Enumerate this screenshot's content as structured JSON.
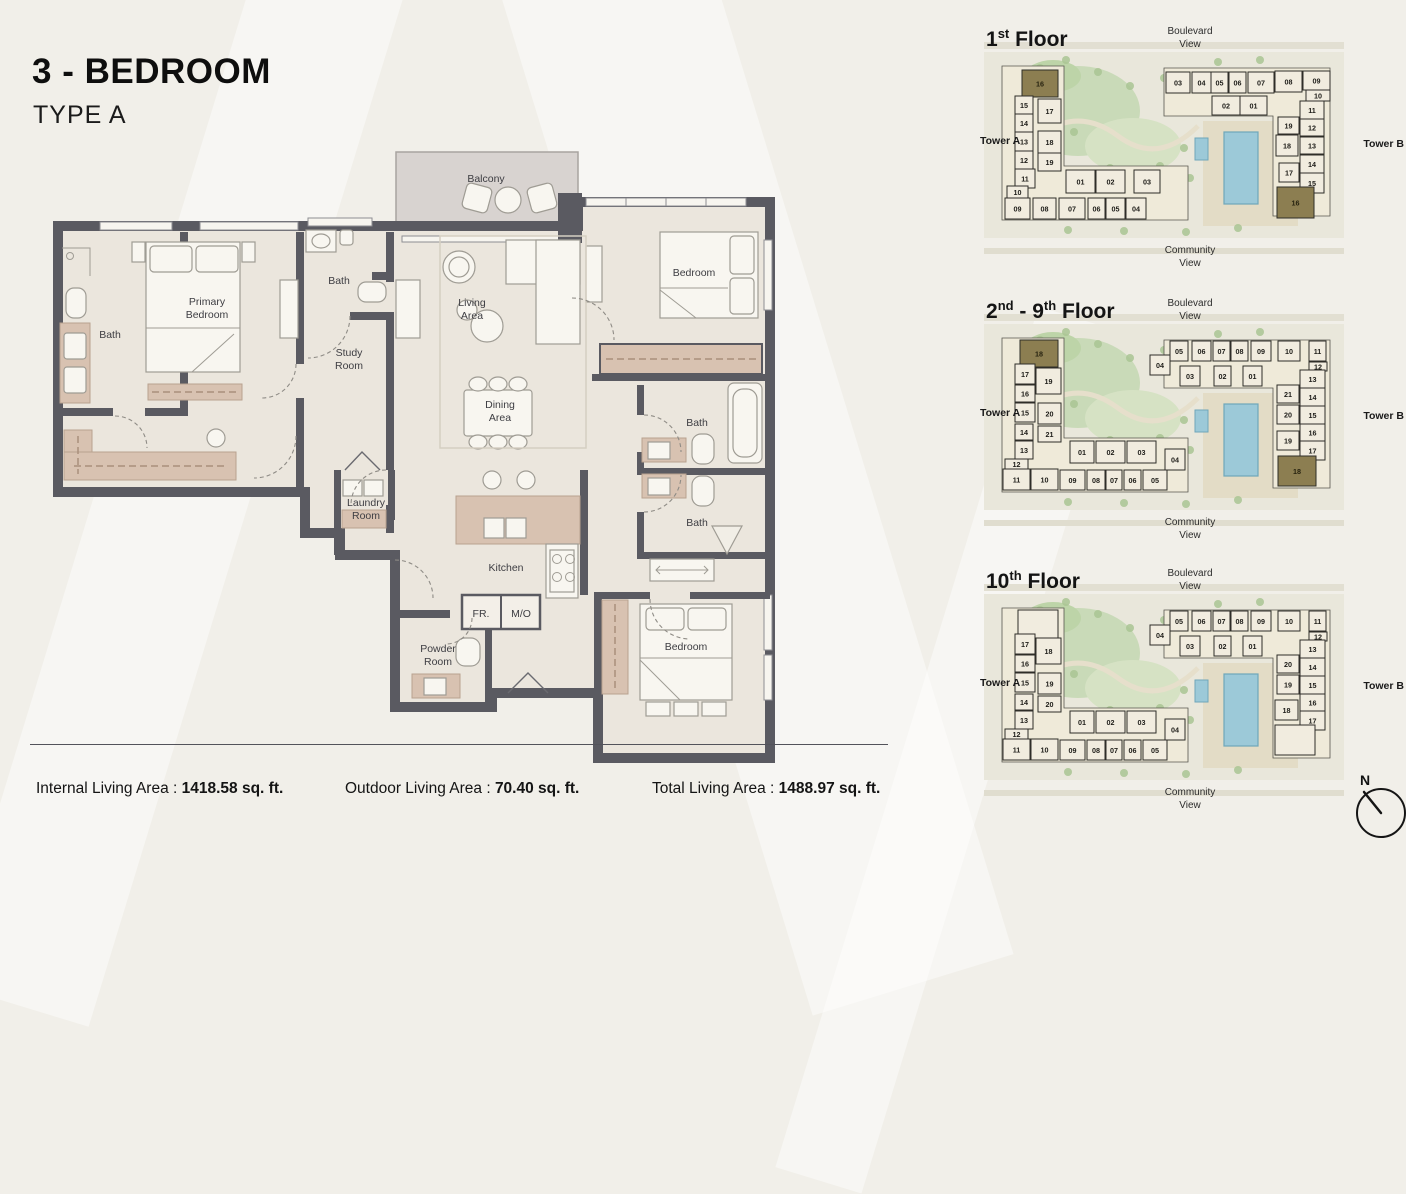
{
  "header": {
    "title": "3 - BEDROOM",
    "subtitle": "TYPE A"
  },
  "stats": [
    {
      "label": "Internal Living Area",
      "sep": " : ",
      "value": "1418.58 sq. ft."
    },
    {
      "label": "Outdoor Living Area",
      "sep": " : ",
      "value": "70.40 sq. ft."
    },
    {
      "label": "Total Living Area",
      "sep": " : ",
      "value": "1488.97 sq. ft."
    }
  ],
  "floor_plan": {
    "rooms": [
      {
        "id": "bath-left",
        "lines": [
          "Bath"
        ],
        "x": 70,
        "y": 198
      },
      {
        "id": "primary-bedroom",
        "lines": [
          "Primary",
          "Bedroom"
        ],
        "x": 167,
        "y": 165
      },
      {
        "id": "bath-middle",
        "lines": [
          "Bath"
        ],
        "x": 299,
        "y": 144
      },
      {
        "id": "study-room",
        "lines": [
          "Study",
          "Room"
        ],
        "x": 309,
        "y": 216
      },
      {
        "id": "balcony",
        "lines": [
          "Balcony"
        ],
        "x": 446,
        "y": 42
      },
      {
        "id": "living-area",
        "lines": [
          "Living",
          "Area"
        ],
        "x": 432,
        "y": 166
      },
      {
        "id": "bedroom-top",
        "lines": [
          "Bedroom"
        ],
        "x": 654,
        "y": 136
      },
      {
        "id": "dining-area",
        "lines": [
          "Dining",
          "Area"
        ],
        "x": 460,
        "y": 268
      },
      {
        "id": "bath-upper",
        "lines": [
          "Bath"
        ],
        "x": 657,
        "y": 286
      },
      {
        "id": "bath-lower",
        "lines": [
          "Bath"
        ],
        "x": 657,
        "y": 386
      },
      {
        "id": "laundry-room",
        "lines": [
          "Laundry",
          "Room"
        ],
        "x": 326,
        "y": 366
      },
      {
        "id": "kitchen",
        "lines": [
          "Kitchen"
        ],
        "x": 466,
        "y": 431
      },
      {
        "id": "fr",
        "lines": [
          "FR."
        ],
        "x": 441,
        "y": 477
      },
      {
        "id": "mo",
        "lines": [
          "M/O"
        ],
        "x": 481,
        "y": 477
      },
      {
        "id": "powder-room",
        "lines": [
          "Powder",
          "Room"
        ],
        "x": 398,
        "y": 512
      },
      {
        "id": "bedroom-bottom",
        "lines": [
          "Bedroom"
        ],
        "x": 646,
        "y": 510
      }
    ]
  },
  "key_plans": [
    {
      "id": "1st-floor",
      "title": [
        [
          "1",
          false
        ],
        [
          "st",
          true
        ],
        [
          " Floor",
          false
        ]
      ],
      "boulevard": [
        "Boulevard",
        "View"
      ],
      "community": [
        "Community",
        "View"
      ],
      "tower_a": "Tower A",
      "tower_b": "Tower B",
      "units_a": [
        [
          "16",
          44,
          54,
          36,
          27,
          1
        ],
        [
          "15",
          37,
          80,
          18,
          18
        ],
        [
          "14",
          37,
          98,
          18,
          18
        ],
        [
          "13",
          37,
          116,
          18,
          19
        ],
        [
          "12",
          37,
          135,
          18,
          18
        ],
        [
          "11",
          37,
          153,
          20,
          19
        ],
        [
          "17",
          60,
          83,
          23,
          24
        ],
        [
          "18",
          60,
          115,
          23,
          22
        ],
        [
          "19",
          60,
          137,
          23,
          18
        ],
        [
          "10",
          29,
          170,
          21,
          12
        ],
        [
          "09",
          27,
          182,
          25,
          21
        ],
        [
          "08",
          55,
          182,
          23,
          21
        ],
        [
          "07",
          81,
          182,
          26,
          21
        ],
        [
          "06",
          110,
          182,
          17,
          21
        ],
        [
          "05",
          128,
          182,
          19,
          21
        ],
        [
          "04",
          148,
          182,
          20,
          21
        ],
        [
          "01",
          88,
          154,
          29,
          23
        ],
        [
          "02",
          118,
          154,
          29,
          23
        ],
        [
          "03",
          156,
          154,
          26,
          23
        ]
      ],
      "units_b": [
        [
          "03",
          188,
          56,
          24,
          21
        ],
        [
          "04",
          214,
          56,
          19,
          21
        ],
        [
          "05",
          233,
          56,
          17,
          21
        ],
        [
          "06",
          251,
          56,
          17,
          21
        ],
        [
          "07",
          270,
          56,
          26,
          21
        ],
        [
          "08",
          297,
          55,
          27,
          21
        ],
        [
          "09",
          325,
          55,
          27,
          19
        ],
        [
          "10",
          328,
          74,
          24,
          11
        ],
        [
          "02",
          234,
          80,
          28,
          19
        ],
        [
          "01",
          262,
          80,
          27,
          19
        ],
        [
          "11",
          322,
          85,
          24,
          18
        ],
        [
          "12",
          322,
          103,
          24,
          17
        ],
        [
          "13",
          322,
          121,
          24,
          17
        ],
        [
          "14",
          322,
          139,
          24,
          18
        ],
        [
          "15",
          322,
          157,
          24,
          20
        ],
        [
          "19",
          300,
          101,
          21,
          17
        ],
        [
          "18",
          298,
          119,
          22,
          21
        ],
        [
          "17",
          301,
          147,
          20,
          19
        ],
        [
          "16",
          299,
          171,
          37,
          31,
          1
        ]
      ]
    },
    {
      "id": "2nd-9th-floor",
      "title": [
        [
          "2",
          false
        ],
        [
          "nd",
          true
        ],
        [
          " - 9",
          false
        ],
        [
          "th",
          true
        ],
        [
          " Floor",
          false
        ]
      ],
      "boulevard": [
        "Boulevard",
        "View"
      ],
      "community": [
        "Community",
        "View"
      ],
      "tower_a": "Tower A",
      "tower_b": "Tower B",
      "units_a": [
        [
          "18",
          42,
          52,
          38,
          27,
          1
        ],
        [
          "17",
          37,
          76,
          20,
          20
        ],
        [
          "16",
          37,
          97,
          20,
          17
        ],
        [
          "15",
          37,
          115,
          20,
          19
        ],
        [
          "14",
          37,
          136,
          18,
          16
        ],
        [
          "13",
          37,
          153,
          18,
          18
        ],
        [
          "19",
          58,
          80,
          25,
          26
        ],
        [
          "20",
          60,
          115,
          23,
          21
        ],
        [
          "21",
          60,
          138,
          23,
          16
        ],
        [
          "12",
          27,
          171,
          23,
          10
        ],
        [
          "11",
          25,
          181,
          27,
          21
        ],
        [
          "10",
          53,
          181,
          27,
          21
        ],
        [
          "09",
          82,
          182,
          25,
          20
        ],
        [
          "08",
          109,
          182,
          18,
          20
        ],
        [
          "07",
          128,
          182,
          16,
          20
        ],
        [
          "06",
          146,
          182,
          17,
          20
        ],
        [
          "05",
          165,
          182,
          24,
          20
        ],
        [
          "04",
          187,
          161,
          20,
          21
        ],
        [
          "01",
          92,
          153,
          24,
          22
        ],
        [
          "02",
          118,
          153,
          29,
          22
        ],
        [
          "03",
          149,
          153,
          29,
          22
        ]
      ],
      "units_b": [
        [
          "05",
          192,
          53,
          18,
          20
        ],
        [
          "06",
          214,
          53,
          19,
          20
        ],
        [
          "07",
          235,
          53,
          17,
          20
        ],
        [
          "08",
          253,
          53,
          17,
          20
        ],
        [
          "09",
          273,
          53,
          20,
          20
        ],
        [
          "10",
          300,
          53,
          22,
          20
        ],
        [
          "11",
          331,
          53,
          17,
          20
        ],
        [
          "04",
          172,
          67,
          20,
          20
        ],
        [
          "12",
          331,
          74,
          18,
          9
        ],
        [
          "03",
          202,
          78,
          20,
          20
        ],
        [
          "02",
          236,
          78,
          17,
          20
        ],
        [
          "01",
          265,
          78,
          19,
          20
        ],
        [
          "13",
          322,
          82,
          25,
          18
        ],
        [
          "14",
          322,
          100,
          25,
          18
        ],
        [
          "15",
          322,
          118,
          25,
          18
        ],
        [
          "16",
          322,
          136,
          25,
          17
        ],
        [
          "17",
          322,
          153,
          25,
          19
        ],
        [
          "21",
          299,
          97,
          22,
          18
        ],
        [
          "20",
          299,
          117,
          22,
          19
        ],
        [
          "19",
          299,
          143,
          22,
          19
        ],
        [
          "18",
          300,
          168,
          38,
          30,
          1
        ]
      ]
    },
    {
      "id": "10th-floor",
      "title": [
        [
          "10",
          false
        ],
        [
          "th",
          true
        ],
        [
          " Floor",
          false
        ]
      ],
      "boulevard": [
        "Boulevard",
        "View"
      ],
      "community": [
        "Community",
        "View"
      ],
      "tower_a": "Tower A",
      "tower_b": "Tower B",
      "units_a": [
        [
          "",
          40,
          52,
          40,
          32
        ],
        [
          "17",
          37,
          76,
          20,
          20
        ],
        [
          "16",
          37,
          97,
          20,
          17
        ],
        [
          "15",
          37,
          115,
          20,
          19
        ],
        [
          "14",
          37,
          136,
          18,
          16
        ],
        [
          "13",
          37,
          153,
          18,
          18
        ],
        [
          "18",
          58,
          80,
          25,
          26
        ],
        [
          "19",
          60,
          115,
          23,
          21
        ],
        [
          "20",
          60,
          138,
          23,
          16
        ],
        [
          "12",
          27,
          171,
          23,
          10
        ],
        [
          "11",
          25,
          181,
          27,
          21
        ],
        [
          "10",
          53,
          181,
          27,
          21
        ],
        [
          "09",
          82,
          182,
          25,
          20
        ],
        [
          "08",
          109,
          182,
          18,
          20
        ],
        [
          "07",
          128,
          182,
          16,
          20
        ],
        [
          "06",
          146,
          182,
          17,
          20
        ],
        [
          "05",
          165,
          182,
          24,
          20
        ],
        [
          "04",
          187,
          161,
          20,
          21
        ],
        [
          "01",
          92,
          153,
          24,
          22
        ],
        [
          "02",
          118,
          153,
          29,
          22
        ],
        [
          "03",
          149,
          153,
          29,
          22
        ]
      ],
      "units_b": [
        [
          "05",
          192,
          53,
          18,
          20
        ],
        [
          "06",
          214,
          53,
          19,
          20
        ],
        [
          "07",
          235,
          53,
          17,
          20
        ],
        [
          "08",
          253,
          53,
          17,
          20
        ],
        [
          "09",
          273,
          53,
          20,
          20
        ],
        [
          "10",
          300,
          53,
          22,
          20
        ],
        [
          "11",
          331,
          53,
          17,
          20
        ],
        [
          "04",
          172,
          67,
          20,
          20
        ],
        [
          "12",
          331,
          74,
          18,
          9
        ],
        [
          "03",
          202,
          78,
          20,
          20
        ],
        [
          "02",
          236,
          78,
          17,
          20
        ],
        [
          "01",
          265,
          78,
          19,
          20
        ],
        [
          "13",
          322,
          82,
          25,
          18
        ],
        [
          "14",
          322,
          100,
          25,
          18
        ],
        [
          "15",
          322,
          118,
          25,
          18
        ],
        [
          "16",
          322,
          136,
          25,
          17
        ],
        [
          "17",
          322,
          153,
          25,
          19
        ],
        [
          "20",
          299,
          97,
          22,
          18
        ],
        [
          "19",
          299,
          117,
          22,
          19
        ],
        [
          "18",
          297,
          142,
          23,
          20
        ],
        [
          "",
          297,
          167,
          40,
          30
        ]
      ]
    }
  ],
  "compass": {
    "label": "N"
  },
  "colors": {
    "wall": "#5a5a61",
    "floor": "#ebe6dd",
    "balcony": "#d8d3d0",
    "tan": "#d8c2b1",
    "unit_fill": "#f1ecdf",
    "unit_highlight": "#8c7e51",
    "pool": "#9cc9d8",
    "lawn": "#c9dab8"
  }
}
